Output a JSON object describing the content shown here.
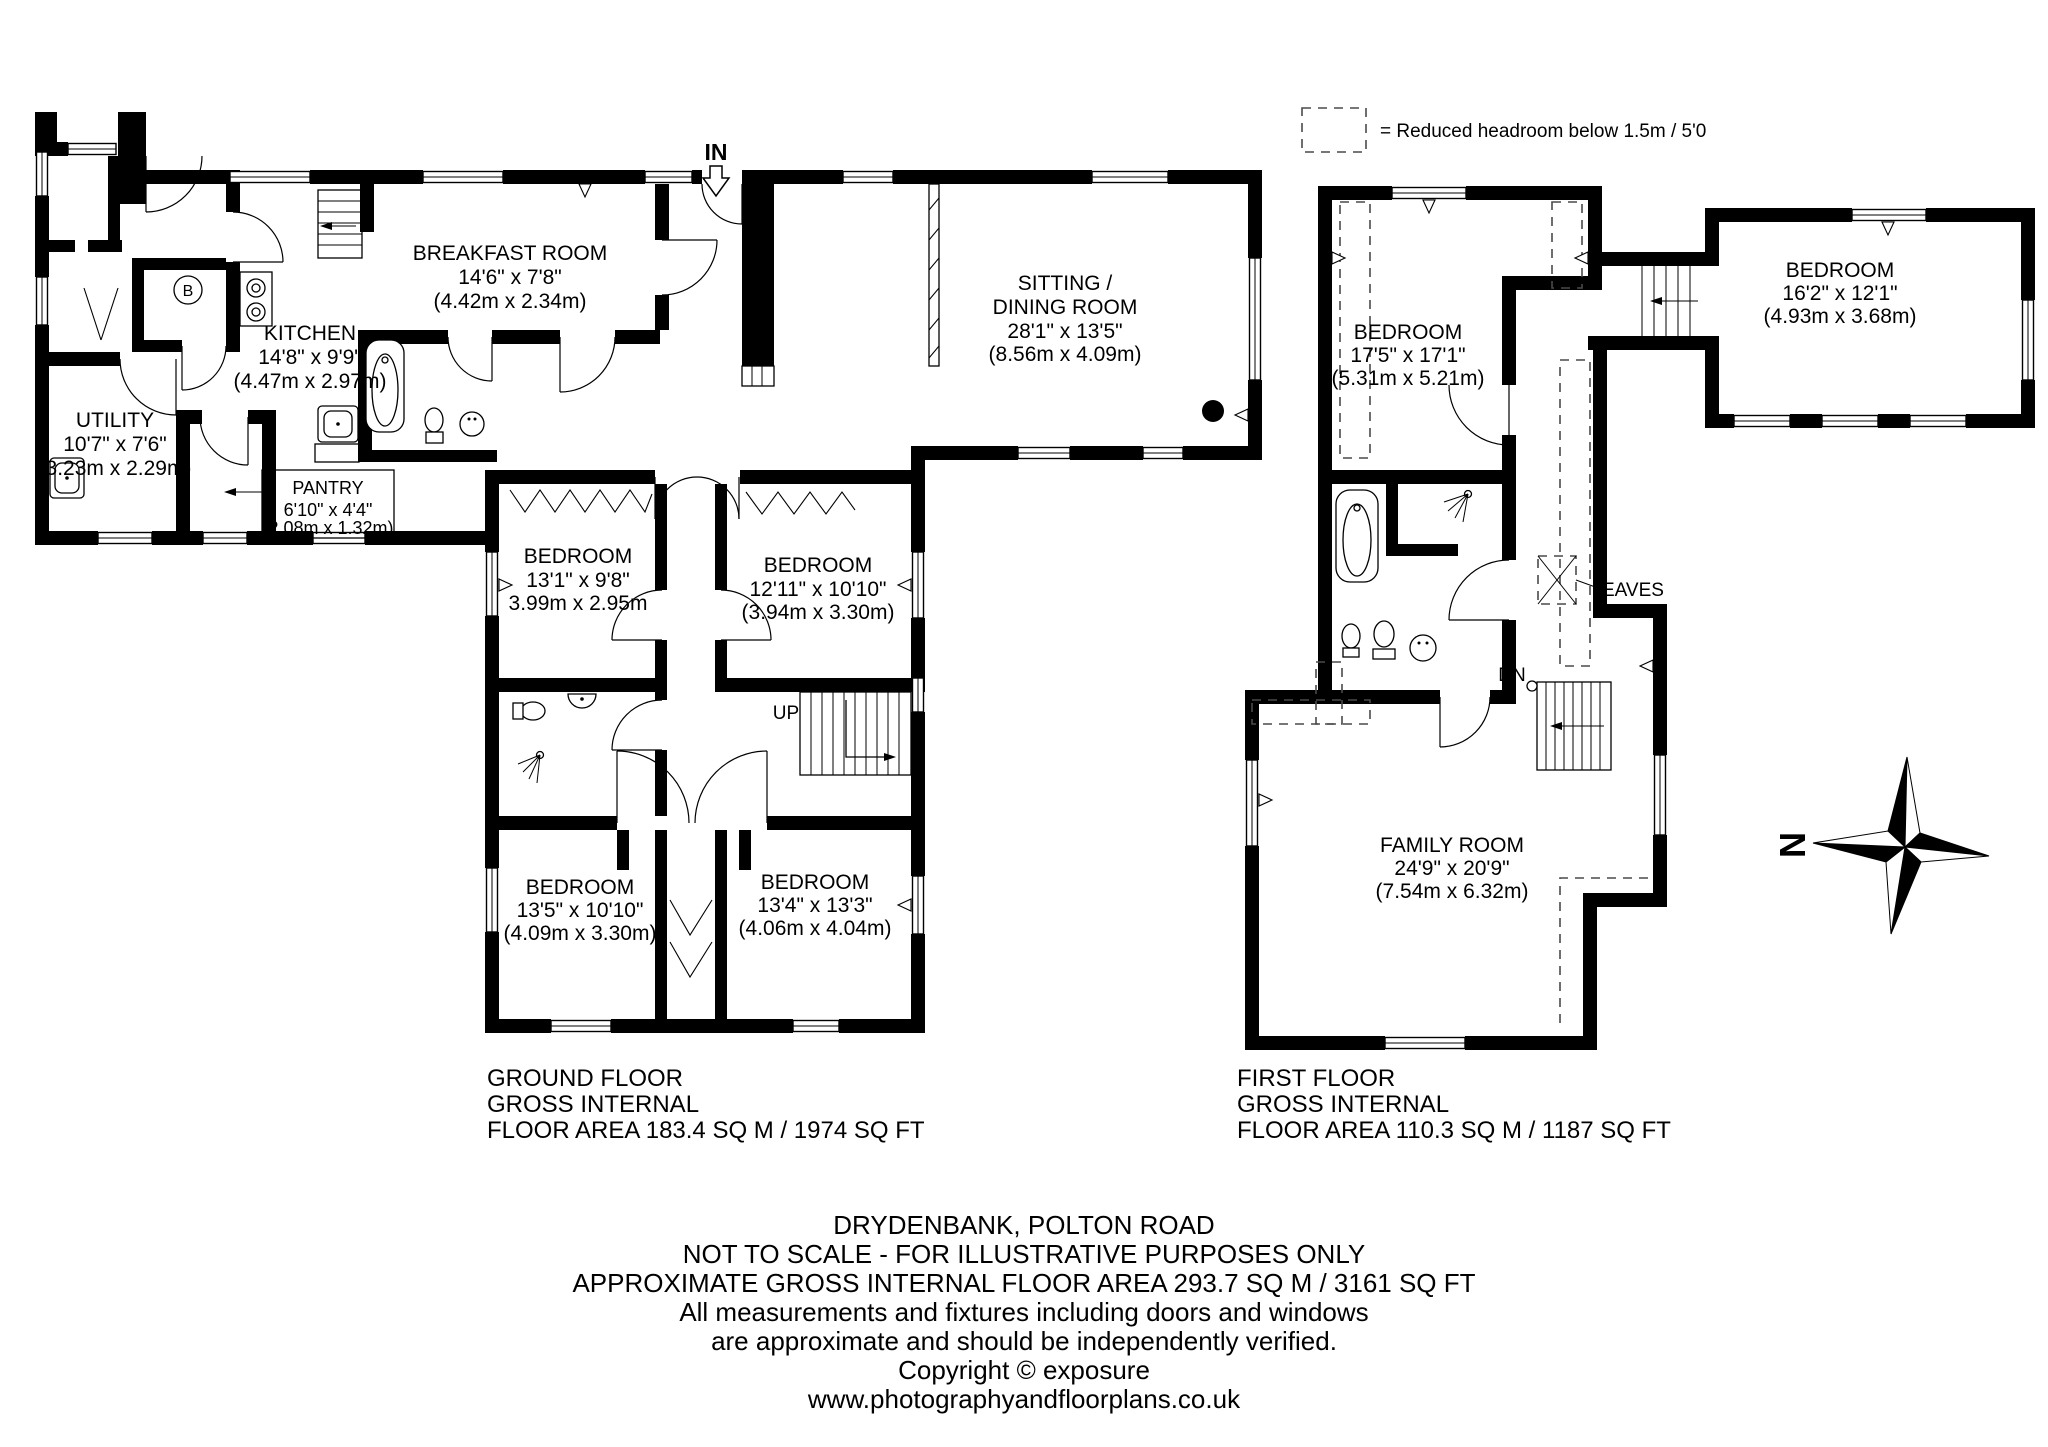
{
  "legend": {
    "text": "= Reduced headroom below 1.5m / 5'0"
  },
  "labels": {
    "in": "IN",
    "up": "UP",
    "dn": "DN",
    "eaves": "EAVES",
    "boiler": "B",
    "north": "N"
  },
  "ground_floor": {
    "rooms": {
      "breakfast": {
        "name": "BREAKFAST ROOM",
        "imperial": "14'6\" x 7'8\"",
        "metric": "(4.42m x 2.34m)"
      },
      "kitchen": {
        "name": "KITCHEN",
        "imperial": "14'8\" x 9'9\"",
        "metric": "(4.47m x 2.97m)"
      },
      "utility": {
        "name": "UTILITY",
        "imperial": "10'7\" x 7'6\"",
        "metric": "(3.23m x 2.29m)"
      },
      "pantry": {
        "name": "PANTRY",
        "imperial": "6'10\" x 4'4\"",
        "metric": "(2.08m x 1.32m)"
      },
      "sitting": {
        "name1": "SITTING /",
        "name2": "DINING ROOM",
        "imperial": "28'1\" x 13'5\"",
        "metric": "(8.56m x 4.09m)"
      },
      "bedroom1": {
        "name": "BEDROOM",
        "imperial": "13'1\" x 9'8\"",
        "metric": "3.99m x 2.95m"
      },
      "bedroom2": {
        "name": "BEDROOM",
        "imperial": "12'11\" x 10'10\"",
        "metric": "(3.94m x 3.30m)"
      },
      "bedroom3": {
        "name": "BEDROOM",
        "imperial": "13'5\" x 10'10\"",
        "metric": "(4.09m x 3.30m)"
      },
      "bedroom4": {
        "name": "BEDROOM",
        "imperial": "13'4\" x 13'3\"",
        "metric": "(4.06m x 4.04m)"
      }
    },
    "footer": {
      "line1": "GROUND FLOOR",
      "line2": "GROSS INTERNAL",
      "line3": "FLOOR AREA 183.4 SQ M / 1974 SQ FT"
    }
  },
  "first_floor": {
    "rooms": {
      "bedroom_main": {
        "name": "BEDROOM",
        "imperial": "17'5\" x 17'1\"",
        "metric": "(5.31m x 5.21m)"
      },
      "bedroom_right": {
        "name": "BEDROOM",
        "imperial": "16'2\" x 12'1\"",
        "metric": "(4.93m x 3.68m)"
      },
      "family": {
        "name": "FAMILY ROOM",
        "imperial": "24'9\" x 20'9\"",
        "metric": "(7.54m x 6.32m)"
      }
    },
    "footer": {
      "line1": "FIRST FLOOR",
      "line2": "GROSS INTERNAL",
      "line3": "FLOOR AREA 110.3 SQ M / 1187 SQ FT"
    }
  },
  "footer_notes": {
    "line1": "DRYDENBANK, POLTON ROAD",
    "line2": "NOT TO SCALE - FOR ILLUSTRATIVE PURPOSES ONLY",
    "line3": "APPROXIMATE GROSS INTERNAL FLOOR AREA 293.7 SQ M / 3161 SQ FT",
    "line4": "All measurements and fixtures including doors and windows",
    "line5": "are approximate and should be independently verified.",
    "line6": "Copyright © exposure",
    "line7": "www.photographyandfloorplans.co.uk"
  }
}
